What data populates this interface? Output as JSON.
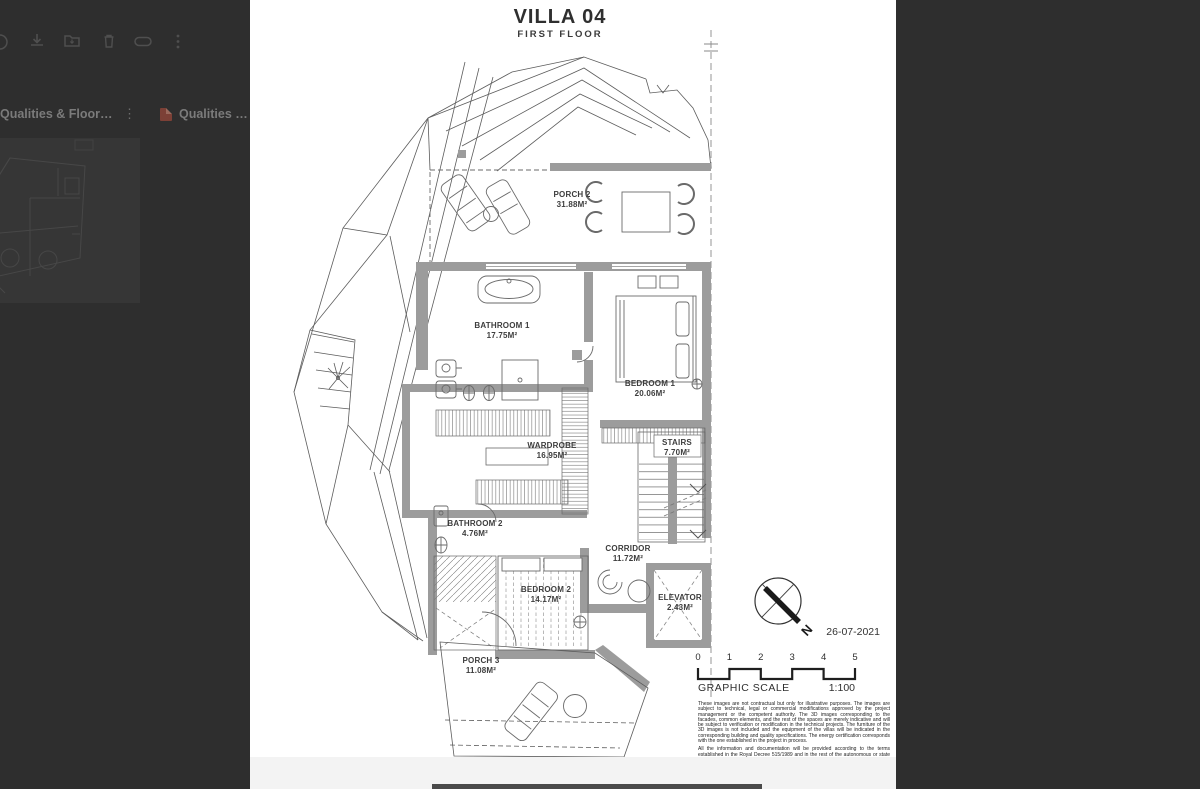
{
  "colors": {
    "overlay_bg": "#2e2e2e",
    "page_bg": "#ffffff",
    "wall_gray": "#9c9c9c",
    "pdf_icon_red": "#7c4036"
  },
  "toolbar": {
    "icons": [
      "download-icon",
      "add-to-folder-icon",
      "trash-icon",
      "link-icon",
      "more-options-icon"
    ]
  },
  "file_browser": {
    "cards": [
      {
        "title": "Qualities & Floorpla...",
        "menu_icon": "kebab-menu-icon"
      },
      {
        "title": "Qualities & Floorpla...",
        "file_type_icon": "pdf-icon"
      }
    ]
  },
  "document": {
    "title": "VILLA 04",
    "subtitle": "FIRST FLOOR",
    "date": "26-07-2021",
    "north_label": "N",
    "rooms": [
      {
        "name": "PORCH 2",
        "area": "31.88M²"
      },
      {
        "name": "BATHROOM 1",
        "area": "17.75M²"
      },
      {
        "name": "BEDROOM 1",
        "area": "20.06M²"
      },
      {
        "name": "WARDROBE",
        "area": "16.95M²"
      },
      {
        "name": "STAIRS",
        "area": "7.70M²"
      },
      {
        "name": "BATHROOM 2",
        "area": "4.76M²"
      },
      {
        "name": "CORRIDOR",
        "area": "11.72M²"
      },
      {
        "name": "BEDROOM 2",
        "area": "14.17M²"
      },
      {
        "name": "ELEVATOR",
        "area": "2.43M²"
      },
      {
        "name": "PORCH 3",
        "area": "11.08M²"
      }
    ],
    "scale": {
      "label": "GRAPHIC SCALE",
      "ratio": "1:100",
      "ticks": [
        "0",
        "1",
        "2",
        "3",
        "4",
        "5"
      ]
    },
    "disclaimer": {
      "p1": "These images are not contractual but only for illustrative purposes. The images are subject to technical, legal or commercial modifications approved by the project management or the competent authority. The 3D images corresponding to the facades, common elements, and the rest of the spaces are merely indicative and will be subject to verification or modification in the technical projects. The furniture of the 3D images is not included and the equipment of the villas will be indicated in the corresponding building and quality specifications. The energy certification corresponds with the one established in the project in process.",
      "p2": "All the information and documentation will be provided according to the terms established in the Royal Decree 515/1989 and in the rest of the autonomous or state regulations currently in force that could complement the mentioned Decree."
    }
  }
}
